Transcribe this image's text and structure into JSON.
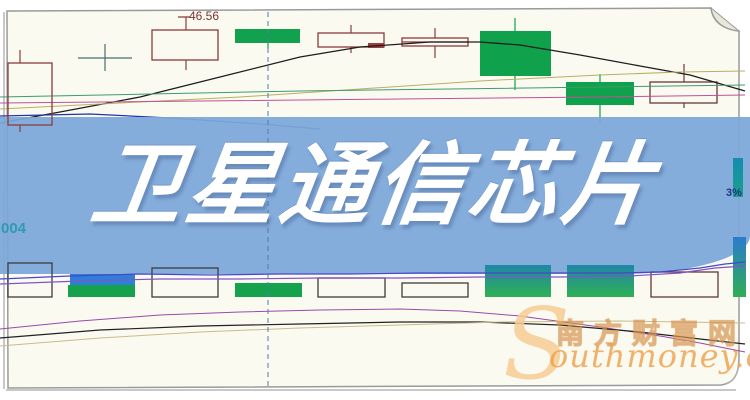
{
  "page": {
    "bg": "#fbfaf0",
    "frame_color": "#9a9a9a",
    "shadow_color": "#c8c8c8",
    "fold_fill": "#e9e7d9"
  },
  "banner": {
    "title": "卫星通信芯片",
    "bg": "#7ca7da",
    "text_color": "#ffffff"
  },
  "labels": {
    "price_high": "46.56",
    "left_axis": "004",
    "right_axis": "3%"
  },
  "watermark": {
    "initial": "S",
    "cn": "南方财富网",
    "en": "outhmoney.com",
    "color": "#e89a4a"
  },
  "chart_data": {
    "type": "candlestick",
    "title": "卫星通信芯片",
    "note": "no numeric axes visible in image; geometry values are image-pixel estimates",
    "price_label_value": 46.56,
    "dashed_crosshair": {
      "x": 268,
      "y1": 12,
      "y2": 386,
      "color": "#4a7fae"
    },
    "gradients": {
      "gvol": {
        "from": "#1f86a8",
        "to": "#2fb054"
      },
      "gtall": {
        "from": "#2a7ccc",
        "to": "#2fae54"
      },
      "gteal": {
        "from": "#128cb0",
        "to": "#1ba089"
      }
    },
    "candles": [
      {
        "i": 1,
        "type": "bullish-hollow",
        "x": 8,
        "w": 44,
        "body_top": 63,
        "body_bottom": 125,
        "wick_x": 20,
        "high_y": 50,
        "low_y": 132,
        "stroke": "#8a3c3c",
        "layer": "overlay"
      },
      {
        "i": 2,
        "type": "doji-cross",
        "cx": 105,
        "cy": 58,
        "half_w": 27,
        "high_y": 44,
        "low_y": 71,
        "stroke": "#4a6e6e",
        "layer": "price"
      },
      {
        "i": 3,
        "type": "bullish-hollow",
        "x": 152,
        "w": 66,
        "body_top": 30,
        "body_bottom": 60,
        "wick_x": 186,
        "high_y": 17,
        "low_y": 70,
        "stroke": "#8a3c3c",
        "layer": "price"
      },
      {
        "i": 4,
        "type": "bearish-filled",
        "x": 235,
        "w": 65,
        "body_top": 29,
        "body_bottom": 43,
        "wick_x": 268,
        "high_y": 29,
        "low_y": 49,
        "fill": "#12a14e",
        "layer": "price"
      },
      {
        "i": 5,
        "type": "bullish-hollow",
        "x": 318,
        "w": 66,
        "body_top": 33,
        "body_bottom": 47,
        "wick_x": 351,
        "high_y": 25,
        "low_y": 53,
        "stroke": "#8a3c3c",
        "layer": "price"
      },
      {
        "i": 6,
        "type": "bullish-hollow",
        "x": 402,
        "w": 66,
        "body_top": 38,
        "body_bottom": 46,
        "wick_x": 435,
        "high_y": 28,
        "low_y": 58,
        "stroke": "#8a3c3c",
        "layer": "price"
      },
      {
        "i": 7,
        "type": "bearish-filled",
        "x": 480,
        "w": 71,
        "body_top": 31,
        "body_bottom": 76,
        "wick_x": 515,
        "high_y": 18,
        "low_y": 90,
        "fill": "#0fa14c",
        "layer": "price"
      },
      {
        "i": 8,
        "type": "bearish-filled",
        "x": 566,
        "w": 68,
        "body_top": 82,
        "body_bottom": 105,
        "wick_x": 600,
        "high_y": 74,
        "low_y": 124,
        "fill": "#0fa14c",
        "layer": "price"
      },
      {
        "i": 9,
        "type": "bullish-hollow",
        "x": 650,
        "w": 67,
        "body_top": 82,
        "body_bottom": 103,
        "wick_x": 684,
        "high_y": 64,
        "low_y": 108,
        "stroke": "#6a3838",
        "layer": "price"
      }
    ],
    "extra_rects": [
      {
        "name": "small-red-body",
        "x": 368,
        "y": 43,
        "w": 16,
        "h": 5,
        "fill": "#9c3f3f",
        "layer": "price"
      }
    ],
    "extra_segments": [
      {
        "name": "label-leader",
        "x1": 178,
        "y1": 17,
        "x2": 190,
        "y2": 17,
        "color": "#7a3535",
        "layer": "price"
      },
      {
        "name": "c6-midline",
        "x1": 402,
        "y1": 42,
        "x2": 468,
        "y2": 42,
        "color": "#8a3c3c",
        "layer": "price"
      }
    ],
    "ma_price": [
      {
        "name": "ma-black",
        "color": "#1d1d1d",
        "width": 1.3,
        "points": [
          [
            0,
            123
          ],
          [
            60,
            112
          ],
          [
            140,
            97
          ],
          [
            220,
            77
          ],
          [
            300,
            57
          ],
          [
            360,
            47
          ],
          [
            430,
            42
          ],
          [
            480,
            42
          ],
          [
            520,
            45
          ],
          [
            580,
            55
          ],
          [
            640,
            66
          ],
          [
            690,
            75
          ],
          [
            745,
            91
          ]
        ]
      },
      {
        "name": "ma-khaki",
        "color": "#b8b060",
        "width": 1,
        "points": [
          [
            0,
            109
          ],
          [
            120,
            103
          ],
          [
            240,
            97
          ],
          [
            360,
            89
          ],
          [
            480,
            81
          ],
          [
            600,
            75
          ],
          [
            680,
            72
          ],
          [
            745,
            71
          ]
        ]
      },
      {
        "name": "ma-teal",
        "color": "#3f9a70",
        "width": 1,
        "points": [
          [
            0,
            97
          ],
          [
            150,
            94
          ],
          [
            300,
            91
          ],
          [
            450,
            89
          ],
          [
            600,
            87
          ],
          [
            745,
            85
          ]
        ]
      },
      {
        "name": "ma-magenta",
        "color": "#c0509a",
        "width": 1,
        "points": [
          [
            0,
            103
          ],
          [
            200,
            101
          ],
          [
            400,
            99
          ],
          [
            600,
            97
          ],
          [
            745,
            95
          ]
        ]
      },
      {
        "name": "ma-navy",
        "color": "#2233aa",
        "width": 1.2,
        "points": [
          [
            0,
            116
          ],
          [
            90,
            114
          ],
          [
            170,
            118
          ],
          [
            260,
            124
          ],
          [
            320,
            129
          ]
        ]
      }
    ],
    "volume_bars": [
      {
        "x": 8,
        "y": 263,
        "w": 44,
        "h": 34,
        "style": "outline",
        "color": "#3c3c3c"
      },
      {
        "x": 68,
        "y": 285,
        "w": 67,
        "h": 12,
        "style": "solid",
        "color": "#16a24c"
      },
      {
        "x": 70,
        "y": 274,
        "w": 65,
        "h": 11,
        "style": "solid",
        "color": "#2e7fd6"
      },
      {
        "x": 152,
        "y": 268,
        "w": 66,
        "h": 29,
        "style": "outline",
        "color": "#3c3c3c"
      },
      {
        "x": 235,
        "y": 283,
        "w": 67,
        "h": 14,
        "style": "solid",
        "color": "#16a24c"
      },
      {
        "x": 318,
        "y": 278,
        "w": 67,
        "h": 19,
        "style": "outline",
        "color": "#3c3c3c"
      },
      {
        "x": 402,
        "y": 283,
        "w": 66,
        "h": 14,
        "style": "outline",
        "color": "#3c3c3c"
      },
      {
        "x": 485,
        "y": 265,
        "w": 66,
        "h": 32,
        "style": "gradient",
        "color": "gvol"
      },
      {
        "x": 567,
        "y": 265,
        "w": 67,
        "h": 32,
        "style": "gradient",
        "color": "gvol"
      },
      {
        "x": 651,
        "y": 272,
        "w": 67,
        "h": 25,
        "style": "outline",
        "color": "#5f3a3a"
      },
      {
        "x": 733,
        "y": 237,
        "w": 13,
        "h": 60,
        "style": "gradient",
        "color": "gtall"
      },
      {
        "x": 733,
        "y": 158,
        "w": 10,
        "h": 39,
        "style": "gradient",
        "color": "gteal"
      }
    ],
    "ma_volume": [
      {
        "name": "vol-ma-indigo",
        "color": "#4747cc",
        "width": 1.2,
        "points": [
          [
            0,
            279
          ],
          [
            70,
            276
          ],
          [
            140,
            274
          ],
          [
            210,
            275
          ],
          [
            280,
            274
          ],
          [
            350,
            274
          ],
          [
            420,
            273
          ],
          [
            490,
            273
          ],
          [
            560,
            273
          ],
          [
            620,
            273
          ],
          [
            660,
            272
          ],
          [
            700,
            268
          ],
          [
            725,
            264
          ],
          [
            745,
            262
          ]
        ]
      },
      {
        "name": "vol-ma-violet",
        "color": "#8055c8",
        "width": 1.2,
        "points": [
          [
            0,
            284
          ],
          [
            80,
            281
          ],
          [
            160,
            279
          ],
          [
            240,
            279
          ],
          [
            320,
            278
          ],
          [
            400,
            278
          ],
          [
            480,
            277
          ],
          [
            560,
            277
          ],
          [
            630,
            276
          ],
          [
            680,
            273
          ],
          [
            715,
            268
          ],
          [
            745,
            266
          ]
        ]
      }
    ],
    "indicator_lines": [
      {
        "name": "ind-purple",
        "color": "#9a4aaa",
        "width": 1,
        "points": [
          [
            0,
            329
          ],
          [
            80,
            321
          ],
          [
            160,
            315
          ],
          [
            240,
            312
          ],
          [
            320,
            310
          ],
          [
            400,
            309
          ],
          [
            460,
            311
          ],
          [
            520,
            316
          ],
          [
            600,
            327
          ],
          [
            660,
            336
          ],
          [
            700,
            343
          ],
          [
            745,
            352
          ]
        ]
      },
      {
        "name": "ind-black",
        "color": "#222222",
        "width": 1.2,
        "points": [
          [
            0,
            338
          ],
          [
            100,
            330
          ],
          [
            200,
            326
          ],
          [
            300,
            324
          ],
          [
            400,
            322
          ],
          [
            480,
            322
          ],
          [
            560,
            325
          ],
          [
            640,
            332
          ],
          [
            700,
            339
          ],
          [
            745,
            344
          ]
        ]
      },
      {
        "name": "ind-tan",
        "color": "#c8bc8a",
        "width": 1,
        "points": [
          [
            0,
            346
          ],
          [
            100,
            338
          ],
          [
            200,
            332
          ],
          [
            300,
            328
          ],
          [
            400,
            325
          ],
          [
            500,
            322
          ],
          [
            620,
            321
          ],
          [
            745,
            323
          ]
        ]
      }
    ]
  }
}
